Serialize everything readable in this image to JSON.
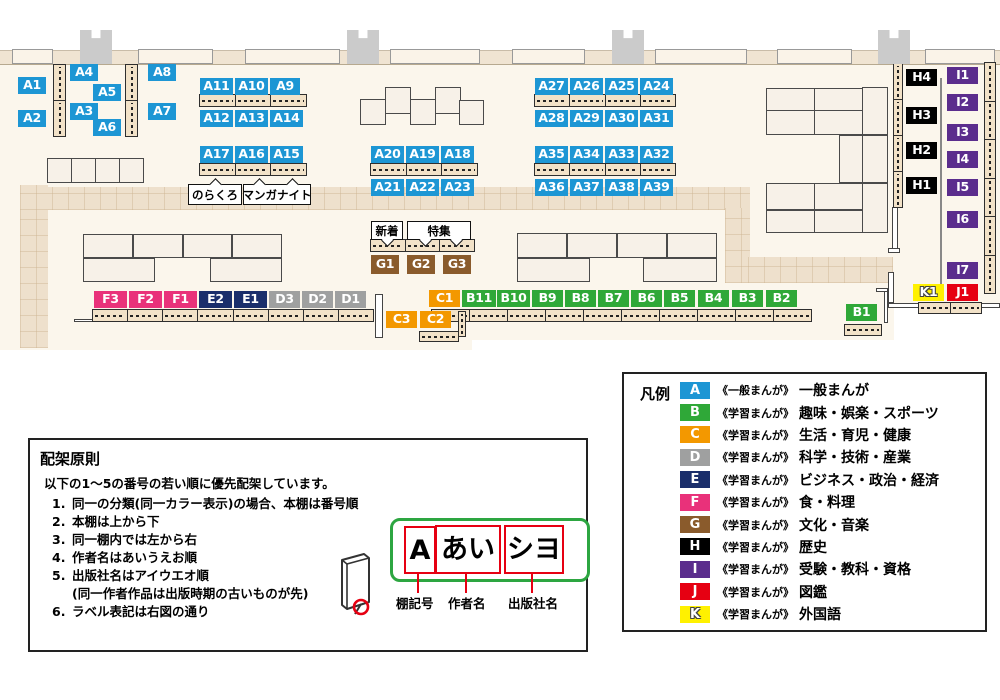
{
  "colors": {
    "A": "#1D96D4",
    "B": "#2FA838",
    "C": "#F39800",
    "D": "#9FA0A0",
    "E": "#1A2E6B",
    "F": "#E9317A",
    "G": "#8A5B2C",
    "H": "#000000",
    "I": "#5B2D8D",
    "J": "#E60012",
    "K": "#FFF100"
  },
  "map": {
    "shelf_labels": [
      {
        "t": "A1",
        "x": 18,
        "y": 77,
        "w": 28
      },
      {
        "t": "A2",
        "x": 18,
        "y": 110,
        "w": 28
      },
      {
        "t": "A4",
        "x": 70,
        "y": 64,
        "w": 28
      },
      {
        "t": "A5",
        "x": 93,
        "y": 84,
        "w": 28
      },
      {
        "t": "A3",
        "x": 70,
        "y": 103,
        "w": 28
      },
      {
        "t": "A6",
        "x": 93,
        "y": 119,
        "w": 28
      },
      {
        "t": "A8",
        "x": 148,
        "y": 64,
        "w": 28
      },
      {
        "t": "A7",
        "x": 148,
        "y": 103,
        "w": 28
      },
      {
        "t": "A11",
        "x": 200,
        "y": 78,
        "w": 33
      },
      {
        "t": "A10",
        "x": 235,
        "y": 78,
        "w": 33
      },
      {
        "t": "A9",
        "x": 270,
        "y": 78,
        "w": 30
      },
      {
        "t": "A12",
        "x": 200,
        "y": 110,
        "w": 33
      },
      {
        "t": "A13",
        "x": 235,
        "y": 110,
        "w": 33
      },
      {
        "t": "A14",
        "x": 270,
        "y": 110,
        "w": 33
      },
      {
        "t": "A17",
        "x": 200,
        "y": 146,
        "w": 33
      },
      {
        "t": "A16",
        "x": 235,
        "y": 146,
        "w": 33
      },
      {
        "t": "A15",
        "x": 270,
        "y": 146,
        "w": 33
      },
      {
        "t": "A20",
        "x": 371,
        "y": 146,
        "w": 33
      },
      {
        "t": "A19",
        "x": 406,
        "y": 146,
        "w": 33
      },
      {
        "t": "A18",
        "x": 441,
        "y": 146,
        "w": 33
      },
      {
        "t": "A21",
        "x": 371,
        "y": 179,
        "w": 33
      },
      {
        "t": "A22",
        "x": 406,
        "y": 179,
        "w": 33
      },
      {
        "t": "A23",
        "x": 441,
        "y": 179,
        "w": 33
      },
      {
        "t": "A27",
        "x": 535,
        "y": 78,
        "w": 33
      },
      {
        "t": "A26",
        "x": 570,
        "y": 78,
        "w": 33
      },
      {
        "t": "A25",
        "x": 605,
        "y": 78,
        "w": 33
      },
      {
        "t": "A24",
        "x": 640,
        "y": 78,
        "w": 33
      },
      {
        "t": "A28",
        "x": 535,
        "y": 110,
        "w": 33
      },
      {
        "t": "A29",
        "x": 570,
        "y": 110,
        "w": 33
      },
      {
        "t": "A30",
        "x": 605,
        "y": 110,
        "w": 33
      },
      {
        "t": "A31",
        "x": 640,
        "y": 110,
        "w": 33
      },
      {
        "t": "A35",
        "x": 535,
        "y": 146,
        "w": 33
      },
      {
        "t": "A34",
        "x": 570,
        "y": 146,
        "w": 33
      },
      {
        "t": "A33",
        "x": 605,
        "y": 146,
        "w": 33
      },
      {
        "t": "A32",
        "x": 640,
        "y": 146,
        "w": 33
      },
      {
        "t": "A36",
        "x": 535,
        "y": 179,
        "w": 33
      },
      {
        "t": "A37",
        "x": 570,
        "y": 179,
        "w": 33
      },
      {
        "t": "A38",
        "x": 605,
        "y": 179,
        "w": 33
      },
      {
        "t": "A39",
        "x": 640,
        "y": 179,
        "w": 33
      },
      {
        "t": "G1",
        "x": 371,
        "y": 255,
        "w": 28,
        "h": 19
      },
      {
        "t": "G2",
        "x": 407,
        "y": 255,
        "w": 28,
        "h": 19
      },
      {
        "t": "G3",
        "x": 443,
        "y": 255,
        "w": 28,
        "h": 19
      },
      {
        "t": "F3",
        "x": 94,
        "y": 291,
        "w": 33
      },
      {
        "t": "F2",
        "x": 129,
        "y": 291,
        "w": 33
      },
      {
        "t": "F1",
        "x": 164,
        "y": 291,
        "w": 33
      },
      {
        "t": "E2",
        "x": 199,
        "y": 291,
        "w": 33
      },
      {
        "t": "E1",
        "x": 234,
        "y": 291,
        "w": 33
      },
      {
        "t": "D3",
        "x": 269,
        "y": 291,
        "w": 31
      },
      {
        "t": "D2",
        "x": 302,
        "y": 291,
        "w": 31
      },
      {
        "t": "D1",
        "x": 335,
        "y": 291,
        "w": 31
      },
      {
        "t": "C1",
        "x": 429,
        "y": 290,
        "w": 31
      },
      {
        "t": "C3",
        "x": 386,
        "y": 311,
        "w": 31
      },
      {
        "t": "C2",
        "x": 420,
        "y": 311,
        "w": 31
      },
      {
        "t": "B11",
        "x": 462,
        "y": 290,
        "w": 34
      },
      {
        "t": "B10",
        "x": 497,
        "y": 290,
        "w": 33
      },
      {
        "t": "B9",
        "x": 532,
        "y": 290,
        "w": 31
      },
      {
        "t": "B8",
        "x": 565,
        "y": 290,
        "w": 31
      },
      {
        "t": "B7",
        "x": 598,
        "y": 290,
        "w": 31
      },
      {
        "t": "B6",
        "x": 631,
        "y": 290,
        "w": 31
      },
      {
        "t": "B5",
        "x": 664,
        "y": 290,
        "w": 31
      },
      {
        "t": "B4",
        "x": 698,
        "y": 290,
        "w": 31
      },
      {
        "t": "B3",
        "x": 732,
        "y": 290,
        "w": 31
      },
      {
        "t": "B2",
        "x": 766,
        "y": 290,
        "w": 31
      },
      {
        "t": "B1",
        "x": 846,
        "y": 304,
        "w": 31
      },
      {
        "t": "K1",
        "x": 913,
        "y": 284,
        "w": 31
      },
      {
        "t": "J1",
        "x": 947,
        "y": 284,
        "w": 31
      },
      {
        "t": "H4",
        "x": 906,
        "y": 69,
        "w": 31
      },
      {
        "t": "H3",
        "x": 906,
        "y": 107,
        "w": 31
      },
      {
        "t": "H2",
        "x": 906,
        "y": 142,
        "w": 31
      },
      {
        "t": "H1",
        "x": 906,
        "y": 177,
        "w": 31
      },
      {
        "t": "I1",
        "x": 947,
        "y": 67,
        "w": 31
      },
      {
        "t": "I2",
        "x": 947,
        "y": 94,
        "w": 31
      },
      {
        "t": "I3",
        "x": 947,
        "y": 124,
        "w": 31
      },
      {
        "t": "I4",
        "x": 947,
        "y": 151,
        "w": 31
      },
      {
        "t": "I5",
        "x": 947,
        "y": 179,
        "w": 31
      },
      {
        "t": "I6",
        "x": 947,
        "y": 211,
        "w": 31
      },
      {
        "t": "I7",
        "x": 947,
        "y": 262,
        "w": 31
      }
    ],
    "callouts": [
      {
        "text": "のらくろ",
        "x": 188,
        "y": 184,
        "w": 52,
        "h": 19,
        "dir": "up",
        "pointers": [
          22
        ]
      },
      {
        "text": "マンガナイト",
        "x": 243,
        "y": 184,
        "w": 66,
        "h": 19,
        "dir": "up",
        "pointers": [
          11,
          44
        ]
      },
      {
        "text": "新着",
        "x": 371,
        "y": 221,
        "w": 30,
        "h": 17,
        "dir": "down",
        "pointers": [
          11
        ]
      },
      {
        "text": "特集",
        "x": 407,
        "y": 221,
        "w": 62,
        "h": 17,
        "dir": "down",
        "pointers": [
          13,
          44
        ]
      }
    ]
  },
  "legend": {
    "title": "凡例",
    "rows": [
      {
        "key": "A",
        "series": "《一般まんが》",
        "category": "一般まんが"
      },
      {
        "key": "B",
        "series": "《学習まんが》",
        "category": "趣味・娯楽・スポーツ"
      },
      {
        "key": "C",
        "series": "《学習まんが》",
        "category": "生活・育児・健康"
      },
      {
        "key": "D",
        "series": "《学習まんが》",
        "category": "科学・技術・産業"
      },
      {
        "key": "E",
        "series": "《学習まんが》",
        "category": "ビジネス・政治・経済"
      },
      {
        "key": "F",
        "series": "《学習まんが》",
        "category": "食・料理"
      },
      {
        "key": "G",
        "series": "《学習まんが》",
        "category": "文化・音楽"
      },
      {
        "key": "H",
        "series": "《学習まんが》",
        "category": "歴史"
      },
      {
        "key": "I",
        "series": "《学習まんが》",
        "category": "受験・教科・資格"
      },
      {
        "key": "J",
        "series": "《学習まんが》",
        "category": "図鑑"
      },
      {
        "key": "K",
        "series": "《学習まんが》",
        "category": "外国語"
      }
    ]
  },
  "principles": {
    "title": "配架原則",
    "intro": "以下の1〜5の番号の若い順に優先配架しています。",
    "items": [
      {
        "num": "1.",
        "text": "同一の分類(同一カラー表示)の場合、本棚は番号順"
      },
      {
        "num": "2.",
        "text": "本棚は上から下"
      },
      {
        "num": "3.",
        "text": "同一棚内では左から右"
      },
      {
        "num": "4.",
        "text": "作者名はあいうえお順"
      },
      {
        "num": "5.",
        "text": "出版社名はアイウエオ順"
      },
      {
        "num": "",
        "text": "(同一作者作品は出版時期の古いものが先)"
      },
      {
        "num": "6.",
        "text": "ラベル表記は右図の通り"
      }
    ]
  },
  "label_diagram": {
    "boxes": [
      "A",
      "あい",
      "シヨ"
    ],
    "captions": [
      "棚記号",
      "作者名",
      "出版社名"
    ]
  }
}
